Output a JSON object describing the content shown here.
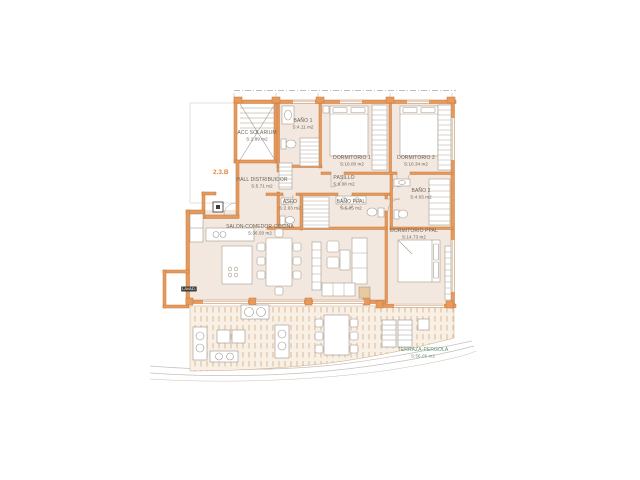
{
  "unit": {
    "label": "2.3.B"
  },
  "rooms": [
    {
      "name": "ACC SOLARIUM",
      "area": "S:1.89 m2"
    },
    {
      "name": "BAÑO 1",
      "area": "S:4.11 m2"
    },
    {
      "name": "DORMITORIO 1",
      "area": "S:10.00 m2"
    },
    {
      "name": "DORMITORIO 2",
      "area": "S:10.34 m2"
    },
    {
      "name": "PASILLO",
      "area": "S:9.08 m2"
    },
    {
      "name": "HALL DISTRIBUIDOR",
      "area": "S:5.71 m2"
    },
    {
      "name": "ASEO",
      "area": "S:2.03 m2"
    },
    {
      "name": "BAÑO PPAL",
      "area": "S:5.05 m2"
    },
    {
      "name": "BAÑO 2",
      "area": "S:4.03 m2"
    },
    {
      "name": "DORMITORIO PPAL",
      "area": "S:14.73 m2"
    },
    {
      "name": "SALON-COMEDOR-COCINA",
      "area": "S:36.50 m2"
    },
    {
      "name": "TERRAZA-PERGOLA",
      "area": "S:56.05 m2"
    }
  ],
  "annotations": {
    "laundry": "LAVAD."
  },
  "colors": {
    "wall": "#e79a5c",
    "wall_outline": "#c6793c",
    "room_fill": "#f2e8df",
    "terrace_hatch": "#dcb48f",
    "unit_label": "#e8843c",
    "room_label": "#6b6156",
    "terrace_label": "#5f8e72"
  }
}
